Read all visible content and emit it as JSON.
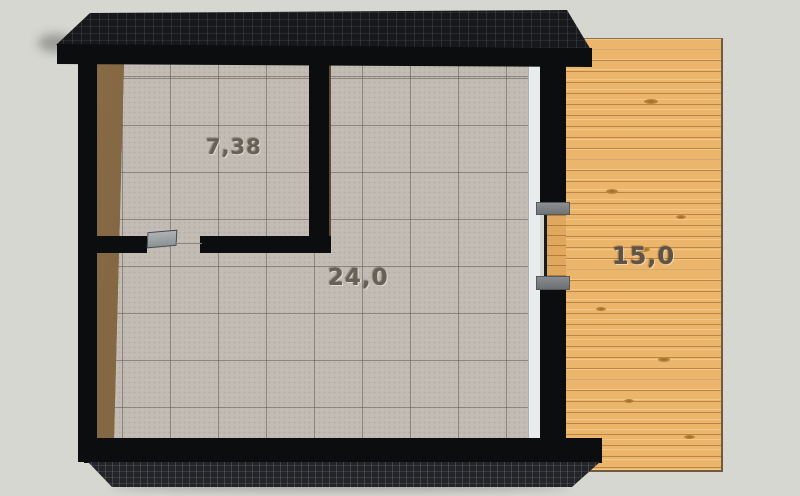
{
  "scene": {
    "description": "3D top-down floor plan render of a small building with a tiled interior split into two rooms and a wooden side deck",
    "background_color": "#d6d7d1"
  },
  "rooms": [
    {
      "name": "small-room",
      "area_label": "7,38"
    },
    {
      "name": "main-room",
      "area_label": "24,0"
    },
    {
      "name": "deck",
      "area_label": "15,0"
    }
  ],
  "colors": {
    "roof": "#17181b",
    "walls": "#0c0d0f",
    "tile_floor": "#c2bcb4",
    "tile_grout": "#8d867c",
    "wood_trim": "#7d6342",
    "deck_wood": "#ecb56c",
    "deck_plank_line": "#c08c48",
    "glass_strip": "#e8ecec",
    "door_leaf": "#9aa0a2",
    "door_frame": "#7e8284",
    "label_text": "#6e655a"
  }
}
